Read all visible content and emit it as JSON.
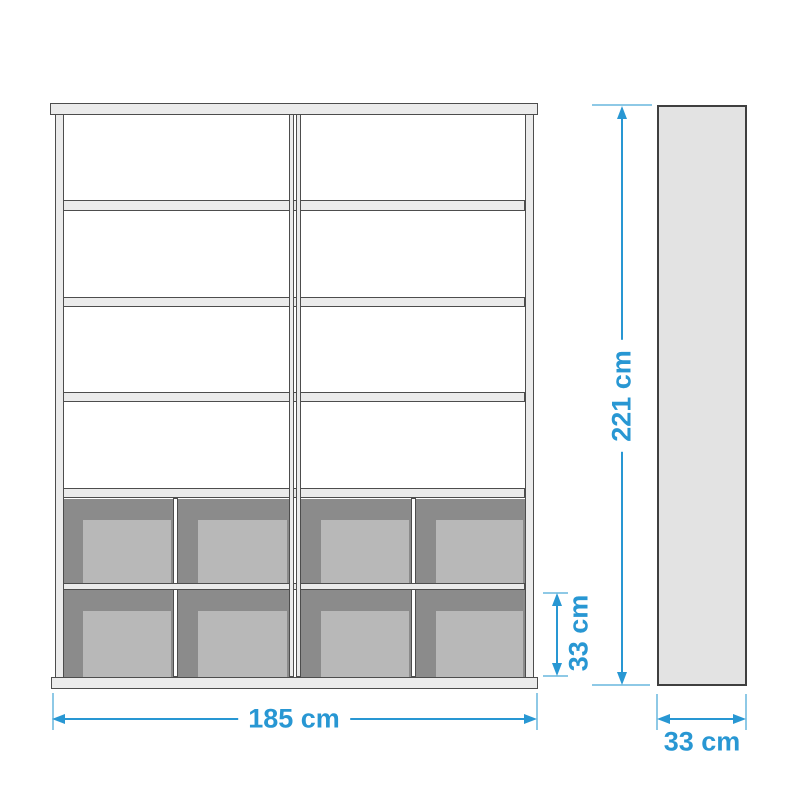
{
  "dimensions": {
    "width_label": "185 cm",
    "height_label": "221 cm",
    "basket_row_height_label": "33 cm",
    "depth_label": "33 cm"
  },
  "structure": {
    "columns": 2,
    "open_shelf_rows": 4,
    "basket_rows": 2,
    "baskets_per_row": 4
  },
  "colors": {
    "dimension_blue": "#2897D3",
    "tick_blue": "#8EC9E6",
    "frame_fill": "#EBEBEB",
    "frame_outline": "#4D4D4D",
    "panel_fill": "#E3E3E3",
    "basket_dark": "#8B8B8B",
    "basket_light": "#B8B8B8",
    "partition_fill": "#FFFFFF",
    "background": "#FFFFFF"
  }
}
